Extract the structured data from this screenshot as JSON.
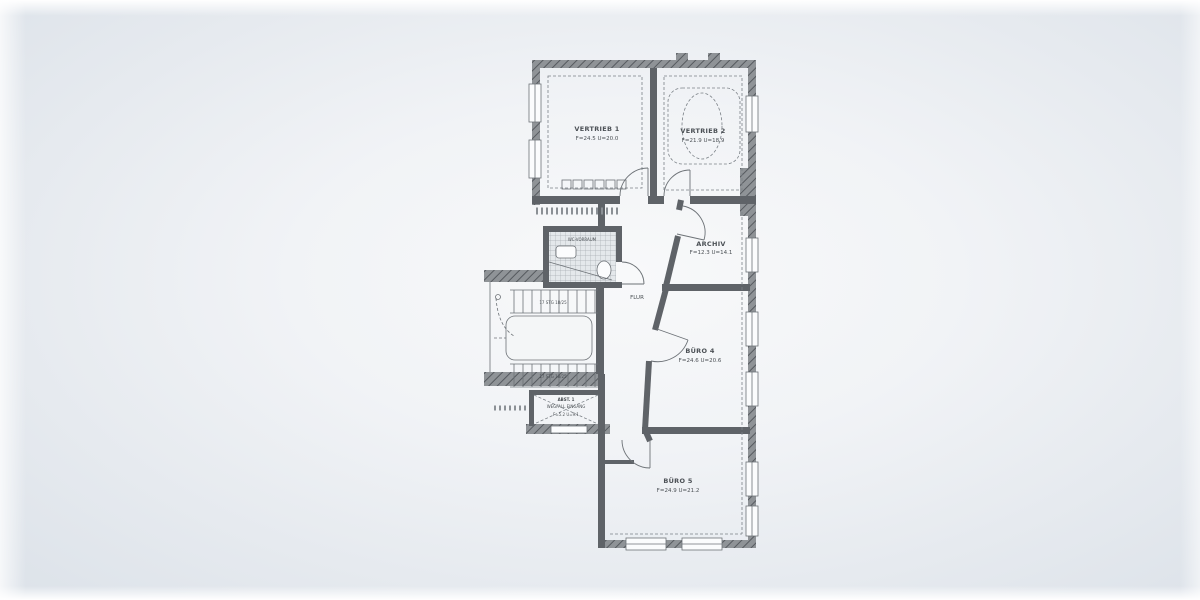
{
  "plan": {
    "rooms": {
      "vertrieb1": {
        "name": "VERTRIEB 1",
        "area": "F=24.5 U=20.0"
      },
      "vertrieb2": {
        "name": "VERTRIEB 2",
        "area": "F=21.9 U=18.9"
      },
      "archiv": {
        "name": "ARCHIV",
        "area": "F=12.3 U=14.1"
      },
      "buero4": {
        "name": "BÜRO 4",
        "area": "F=24.6 U=20.6"
      },
      "buero5": {
        "name": "BÜRO 5",
        "area": "F=24.9 U=21.2"
      },
      "flur": {
        "name": "FLUR"
      },
      "wc": {
        "name": "WC-VORRAUM"
      },
      "abstell": {
        "name": "ABST. 1",
        "note": "WEGFALL EINGANG",
        "area": "F=5.2 U=9.1"
      },
      "stair_upper": {
        "label": "17 STG 18/25"
      },
      "stair_lower": {
        "label": "17 STG 18/25"
      }
    },
    "colors": {
      "paper_center": "#f8f9fa",
      "paper_edge": "#dce2e9",
      "wall": "#5f6368",
      "wall_hatch": "#8f9397",
      "ink": "#4b5055"
    }
  }
}
